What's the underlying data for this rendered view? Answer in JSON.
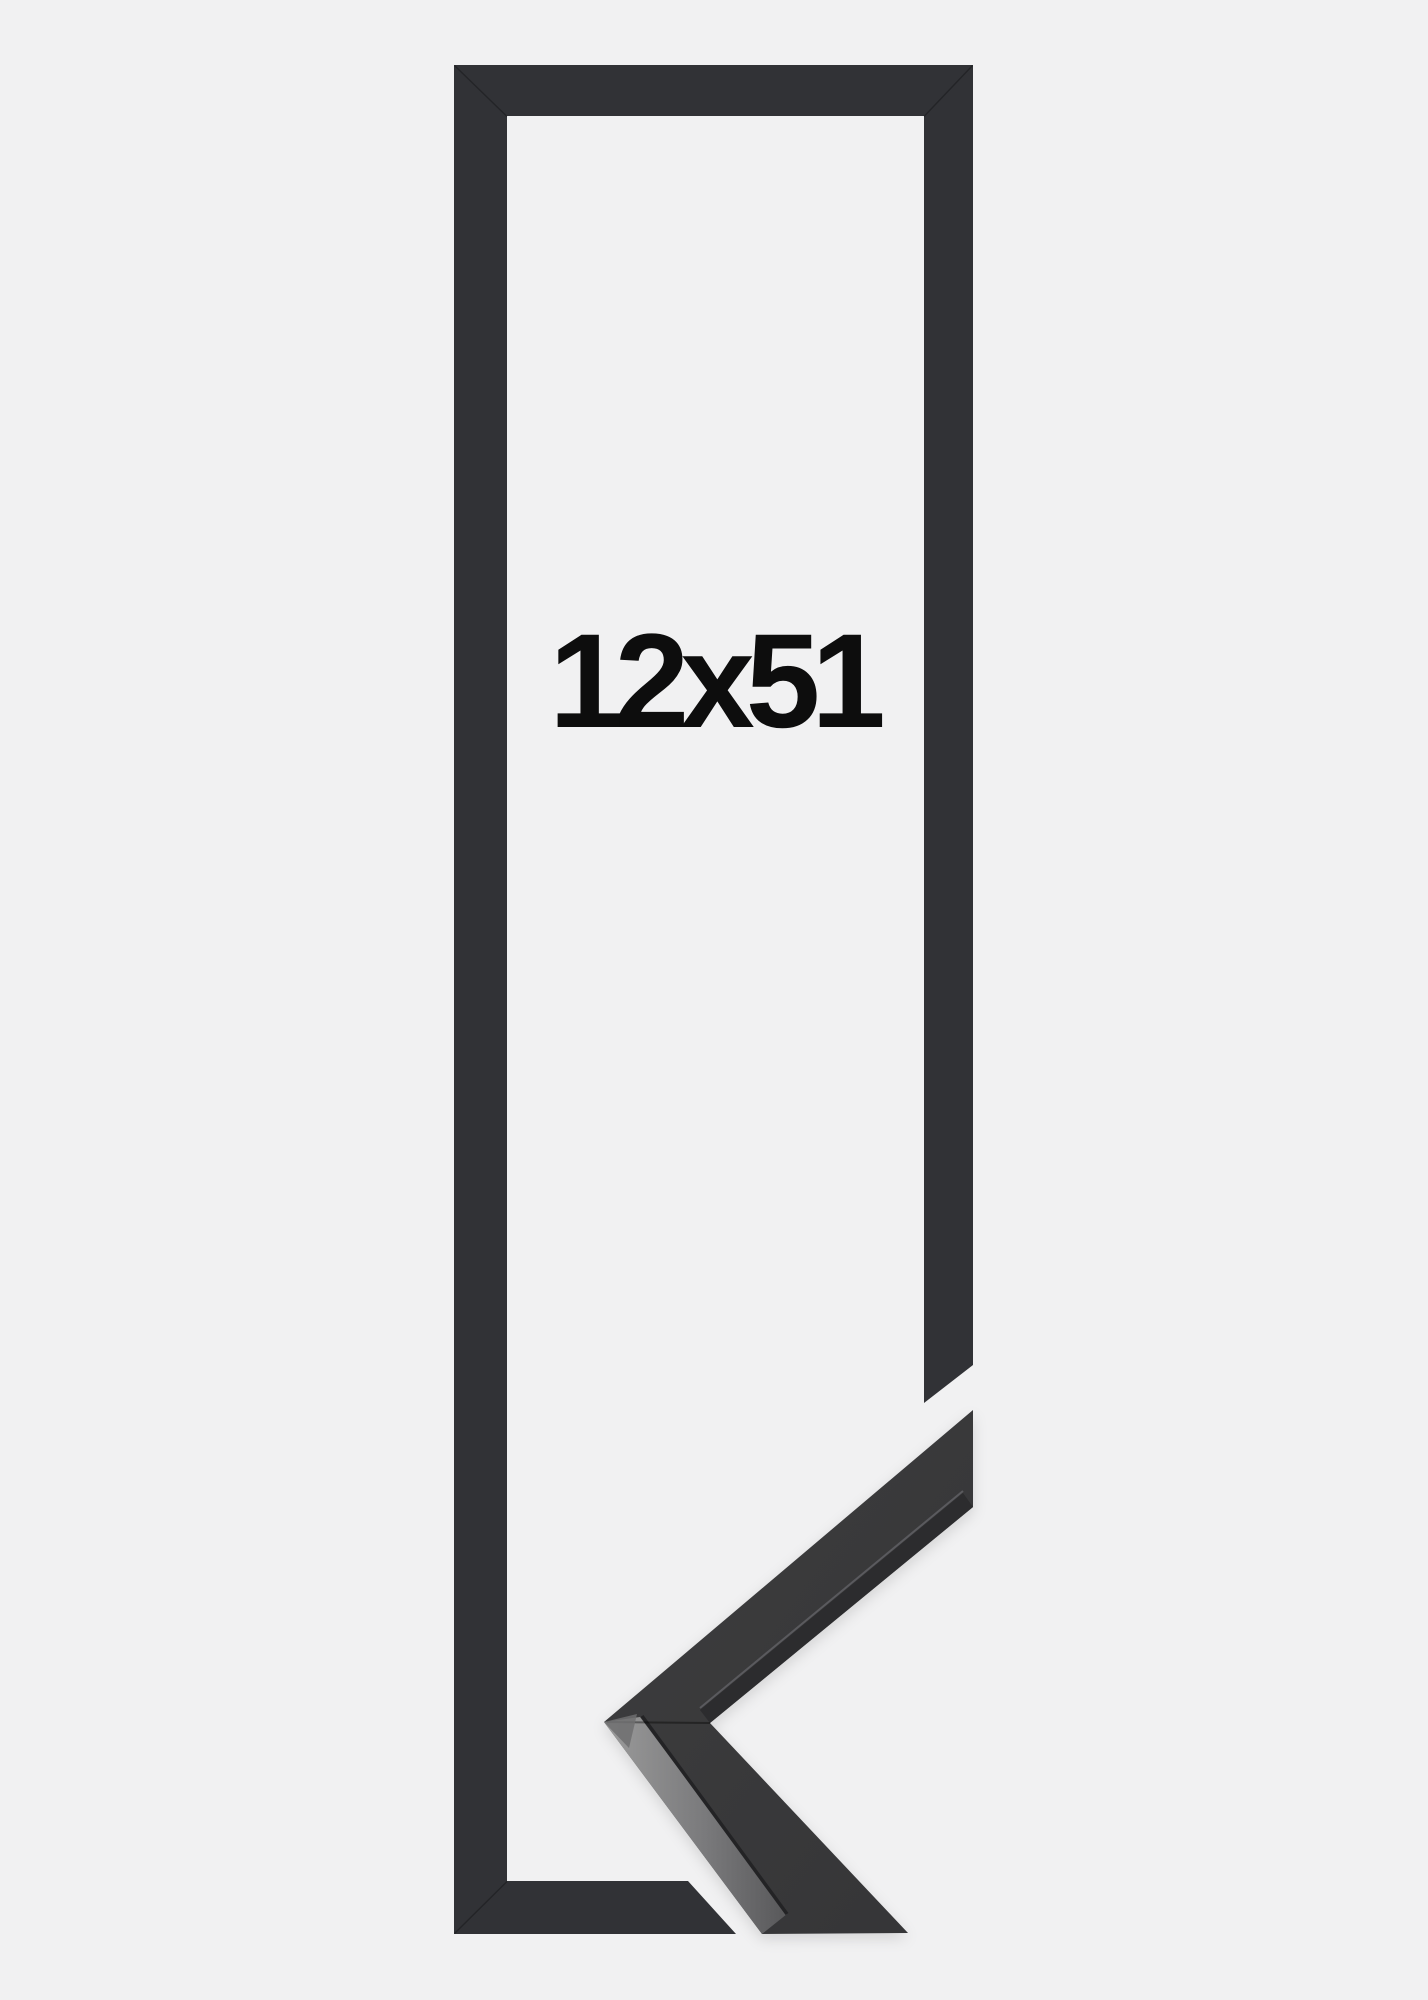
{
  "product": {
    "size_label": "12x51"
  },
  "image": {
    "width_px": 1428,
    "height_px": 2000
  },
  "colors": {
    "background": "#f1f1f2",
    "frame": "#313236",
    "frame_seam": "rgba(0,0,0,0.30)",
    "label": "#0d0d0d",
    "profile-surface": "#3d3d3e",
    "profile-surface-deep": "#353537",
    "profile-side-light": "#9b9b9b",
    "profile-side-mid": "#58585a",
    "profile-inner-strip": "#2c2c2e",
    "profile-highlight": "#5e5e62",
    "profile-arris": "#232325",
    "apex-facet": "#6e6e70"
  }
}
